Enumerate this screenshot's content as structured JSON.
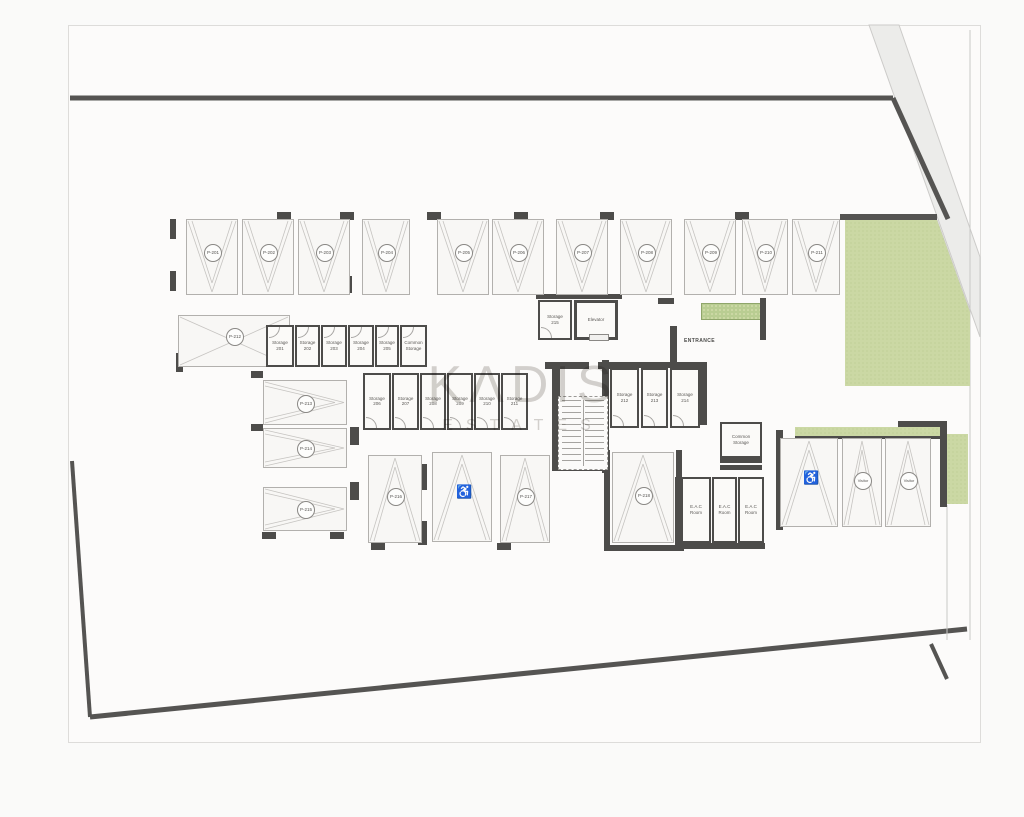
{
  "watermark": {
    "line1": "KΛDIS",
    "line2": "ESTATES"
  },
  "icons": {
    "accessible": "♿"
  },
  "colors": {
    "wall": "#4d4c4a",
    "boundary": "#555452",
    "green": "#cbd8a4",
    "road_fill": "#ececea",
    "road_edge": "#cccbc9",
    "stall_line": "#c6c4c1",
    "page": "#fcfbfa",
    "watermark": "#b3afa9"
  },
  "labels": [
    {
      "text": "ENTRANCE",
      "x": 684,
      "y": 338,
      "size": 5
    }
  ],
  "parking_stalls": [
    {
      "label": "P-201",
      "type": "standard",
      "dir": "down",
      "x": 186,
      "y": 219,
      "w": 52,
      "h": 76
    },
    {
      "label": "P-202",
      "type": "standard",
      "dir": "down",
      "x": 242,
      "y": 219,
      "w": 52,
      "h": 76
    },
    {
      "label": "P-203",
      "type": "standard",
      "dir": "down",
      "x": 298,
      "y": 219,
      "w": 52,
      "h": 76
    },
    {
      "label": "P-204",
      "type": "standard",
      "dir": "down",
      "x": 362,
      "y": 219,
      "w": 48,
      "h": 76
    },
    {
      "label": "P-205",
      "type": "standard",
      "dir": "down",
      "x": 437,
      "y": 219,
      "w": 52,
      "h": 76
    },
    {
      "label": "P-206",
      "type": "standard",
      "dir": "down",
      "x": 492,
      "y": 219,
      "w": 52,
      "h": 76
    },
    {
      "label": "P-207",
      "type": "standard",
      "dir": "down",
      "x": 556,
      "y": 219,
      "w": 52,
      "h": 76
    },
    {
      "label": "P-208",
      "type": "standard",
      "dir": "down",
      "x": 620,
      "y": 219,
      "w": 52,
      "h": 76
    },
    {
      "label": "P-209",
      "type": "standard",
      "dir": "down",
      "x": 684,
      "y": 219,
      "w": 52,
      "h": 76
    },
    {
      "label": "P-210",
      "type": "standard",
      "dir": "down",
      "x": 742,
      "y": 219,
      "w": 46,
      "h": 76
    },
    {
      "label": "P-211",
      "type": "standard",
      "dir": "down",
      "x": 792,
      "y": 219,
      "w": 48,
      "h": 76
    },
    {
      "label": "P-212",
      "type": "ramp",
      "dir": "ramp",
      "x": 178,
      "y": 315,
      "w": 112,
      "h": 52
    },
    {
      "label": "P-213",
      "type": "standard",
      "dir": "right",
      "x": 263,
      "y": 380,
      "w": 84,
      "h": 45
    },
    {
      "label": "P-214",
      "type": "standard",
      "dir": "right",
      "x": 263,
      "y": 428,
      "w": 84,
      "h": 40
    },
    {
      "label": "P-215",
      "type": "standard",
      "dir": "right",
      "x": 263,
      "y": 487,
      "w": 84,
      "h": 44
    },
    {
      "label": "P-216",
      "type": "standard",
      "dir": "up",
      "x": 368,
      "y": 455,
      "w": 54,
      "h": 88
    },
    {
      "label": "",
      "type": "accessible",
      "dir": "up",
      "x": 432,
      "y": 452,
      "w": 60,
      "h": 90
    },
    {
      "label": "P-217",
      "type": "standard",
      "dir": "up",
      "x": 500,
      "y": 455,
      "w": 50,
      "h": 88
    },
    {
      "label": "P-218",
      "type": "standard",
      "dir": "up",
      "x": 612,
      "y": 452,
      "w": 62,
      "h": 91
    },
    {
      "label": "",
      "type": "accessible",
      "dir": "up",
      "x": 780,
      "y": 438,
      "w": 58,
      "h": 89
    },
    {
      "label": "Visitor",
      "type": "visitor",
      "dir": "up",
      "x": 842,
      "y": 438,
      "w": 40,
      "h": 89
    },
    {
      "label": "Visitor",
      "type": "visitor",
      "dir": "up",
      "x": 885,
      "y": 438,
      "w": 46,
      "h": 89
    }
  ],
  "storage_rooms": [
    {
      "l1": "Storage",
      "l2": "201",
      "x": 266,
      "y": 325,
      "w": 28,
      "h": 42,
      "door": "top"
    },
    {
      "l1": "Storage",
      "l2": "202",
      "x": 295,
      "y": 325,
      "w": 25,
      "h": 42,
      "door": "top"
    },
    {
      "l1": "Storage",
      "l2": "203",
      "x": 321,
      "y": 325,
      "w": 26,
      "h": 42,
      "door": "top"
    },
    {
      "l1": "Storage",
      "l2": "204",
      "x": 348,
      "y": 325,
      "w": 26,
      "h": 42,
      "door": "top"
    },
    {
      "l1": "Storage",
      "l2": "205",
      "x": 375,
      "y": 325,
      "w": 24,
      "h": 42,
      "door": "top"
    },
    {
      "l1": "Common",
      "l2": "Storage",
      "x": 400,
      "y": 325,
      "w": 27,
      "h": 42,
      "door": "top"
    },
    {
      "l1": "Storage",
      "l2": "206",
      "x": 363,
      "y": 373,
      "w": 28,
      "h": 57,
      "door": "bottom"
    },
    {
      "l1": "Storage",
      "l2": "207",
      "x": 392,
      "y": 373,
      "w": 27,
      "h": 57,
      "door": "bottom"
    },
    {
      "l1": "Storage",
      "l2": "208",
      "x": 420,
      "y": 373,
      "w": 26,
      "h": 57,
      "door": "bottom"
    },
    {
      "l1": "Storage",
      "l2": "209",
      "x": 447,
      "y": 373,
      "w": 26,
      "h": 57,
      "door": "bottom"
    },
    {
      "l1": "Storage",
      "l2": "210",
      "x": 474,
      "y": 373,
      "w": 26,
      "h": 57,
      "door": "bottom"
    },
    {
      "l1": "Storage",
      "l2": "211",
      "x": 501,
      "y": 373,
      "w": 27,
      "h": 57,
      "door": "bottom"
    },
    {
      "l1": "Storage",
      "l2": "212",
      "x": 610,
      "y": 368,
      "w": 29,
      "h": 60,
      "door": "bottom"
    },
    {
      "l1": "Storage",
      "l2": "213",
      "x": 641,
      "y": 368,
      "w": 27,
      "h": 60,
      "door": "bottom"
    },
    {
      "l1": "Storage",
      "l2": "214",
      "x": 670,
      "y": 368,
      "w": 30,
      "h": 60,
      "door": "bottom"
    },
    {
      "l1": "Storage",
      "l2": "215",
      "x": 538,
      "y": 300,
      "w": 34,
      "h": 40,
      "door": "bottom"
    }
  ],
  "rooms": [
    {
      "l1": "Elevator",
      "l2": "",
      "x": 574,
      "y": 300,
      "w": 44,
      "h": 40,
      "wall": 3
    },
    {
      "l1": "Common",
      "l2": "Storage",
      "x": 720,
      "y": 422,
      "w": 42,
      "h": 36,
      "wall": 2
    },
    {
      "l1": "E.A.C",
      "l2": "Room",
      "x": 681,
      "y": 477,
      "w": 30,
      "h": 66,
      "wall": 2
    },
    {
      "l1": "E.A.C",
      "l2": "Room",
      "x": 712,
      "y": 477,
      "w": 25,
      "h": 66,
      "wall": 2
    },
    {
      "l1": "E.A.C",
      "l2": "Room",
      "x": 738,
      "y": 477,
      "w": 26,
      "h": 66,
      "wall": 2
    }
  ],
  "stairs": {
    "x": 558,
    "y": 396,
    "w": 48,
    "h": 72
  },
  "site": {
    "boundary_lines": [
      [
        70,
        98,
        893,
        98,
        5
      ],
      [
        893,
        98,
        948,
        219,
        5
      ],
      [
        840,
        217,
        937,
        217,
        6
      ],
      [
        72,
        461,
        90,
        717,
        4
      ],
      [
        90,
        717,
        967,
        629,
        5
      ],
      [
        931,
        644,
        947,
        679,
        4
      ]
    ],
    "thin_lines": [
      [
        937,
        220,
        970,
        312,
        1
      ],
      [
        970,
        30,
        970,
        640,
        1
      ],
      [
        947,
        505,
        947,
        640,
        1
      ]
    ],
    "road_band": "869,25 899,25 980,257 980,337",
    "green_areas": [
      {
        "kind": "poly",
        "x": 845,
        "y": 217,
        "w": 125,
        "h": 170,
        "clip": "polygon(0px 3px, 92px 3px, 125px 95px, 125px 169px, 0px 169px)"
      },
      {
        "kind": "hatch",
        "x": 701,
        "y": 303,
        "w": 60,
        "h": 15
      },
      {
        "kind": "rect",
        "x": 795,
        "y": 427,
        "w": 150,
        "h": 9
      },
      {
        "kind": "rect",
        "x": 947,
        "y": 434,
        "w": 21,
        "h": 70
      }
    ]
  },
  "walls": [
    [
      545,
      362,
      44,
      7
    ],
    [
      598,
      362,
      12,
      7
    ],
    [
      552,
      369,
      8,
      102
    ],
    [
      602,
      360,
      7,
      113
    ],
    [
      558,
      464,
      48,
      7
    ],
    [
      609,
      362,
      98,
      6
    ],
    [
      700,
      368,
      7,
      57
    ],
    [
      670,
      326,
      7,
      53
    ],
    [
      658,
      298,
      16,
      6
    ],
    [
      760,
      298,
      6,
      42
    ],
    [
      536,
      294,
      86,
      5
    ],
    [
      720,
      458,
      42,
      5
    ],
    [
      720,
      465,
      42,
      5
    ],
    [
      675,
      477,
      6,
      68
    ],
    [
      675,
      543,
      90,
      6
    ],
    [
      604,
      450,
      6,
      98
    ],
    [
      676,
      450,
      6,
      96
    ],
    [
      604,
      545,
      80,
      6
    ],
    [
      776,
      430,
      7,
      100
    ],
    [
      940,
      421,
      7,
      86
    ],
    [
      898,
      421,
      49,
      6
    ],
    [
      795,
      436,
      152,
      3
    ]
  ],
  "pillars": [
    [
      170,
      219,
      6,
      20
    ],
    [
      170,
      271,
      6,
      20
    ],
    [
      277,
      212,
      14,
      8
    ],
    [
      340,
      212,
      14,
      8
    ],
    [
      427,
      212,
      14,
      8
    ],
    [
      514,
      212,
      14,
      8
    ],
    [
      600,
      212,
      14,
      8
    ],
    [
      735,
      212,
      14,
      8
    ],
    [
      280,
      276,
      9,
      17
    ],
    [
      343,
      276,
      9,
      17
    ],
    [
      176,
      353,
      7,
      19
    ],
    [
      251,
      371,
      12,
      7
    ],
    [
      251,
      424,
      12,
      7
    ],
    [
      350,
      427,
      9,
      18
    ],
    [
      350,
      482,
      9,
      18
    ],
    [
      418,
      464,
      9,
      26
    ],
    [
      418,
      521,
      9,
      24
    ],
    [
      262,
      532,
      14,
      7
    ],
    [
      330,
      532,
      14,
      7
    ],
    [
      371,
      543,
      14,
      7
    ],
    [
      497,
      543,
      14,
      7
    ]
  ]
}
